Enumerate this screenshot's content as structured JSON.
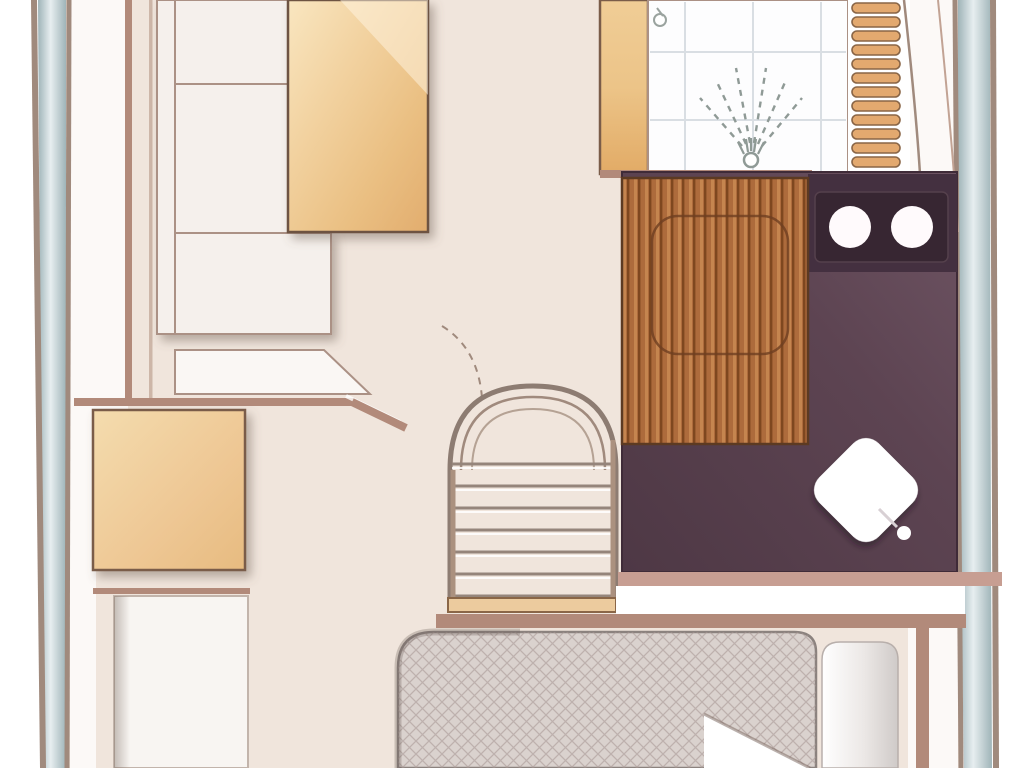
{
  "app": {
    "type": "boat-interior-floor-plan",
    "view": "top-down-deck-plan"
  },
  "palette": {
    "outside": "#ffffff",
    "floor": "#f0e5dc",
    "margin": "#fcf9f7",
    "wall": "#b28a7a",
    "wall-light": "#c79e92",
    "wall-dark": "#7a5c49",
    "line": "#a08a7d",
    "hull-strip-light": "#e7eef0",
    "hull-strip-dark": "#9fb4b8",
    "sofa": "#f5f0ec",
    "sofa-line": "#ab9185",
    "ledge": "#faf7f4",
    "berth": "#f8f5f2",
    "table-light": "#f9e6c0",
    "table-dark": "#e2ad6e",
    "table-edge": "#6d5243",
    "tile": "#fdfdfe",
    "tile-grid": "#d9dee3",
    "spray": "#8f9a96",
    "rung": "#e3a96f",
    "rung-edge": "#8a6647",
    "threshold": "#eccb9e",
    "purple-deep": "#4e3845",
    "purple-mid": "#5d4452",
    "purple-hi": "#6e5463",
    "counter": "#443040",
    "basin": "#372632",
    "sink": "#fffafc",
    "teak-base": "#ad6b3c",
    "teak-dark": "#7e471f",
    "teak-light": "#c5854f",
    "teak-edge": "#5c3a22",
    "mattress": "#dad2ce",
    "mattress-edge": "#8b827e",
    "cross-line": "#b3a6a1",
    "duvet-shade": "#cfcac8",
    "walkway": "#ffffff",
    "toilet": "#ffffff"
  },
  "rooms": {
    "saloon": {
      "features": [
        "l-shaped-sofa",
        "dinette-table",
        "side-ledge"
      ]
    },
    "lower_cabin": {
      "features": [
        "wood-cabinet",
        "single-berth"
      ]
    },
    "bathroom": {
      "features": [
        "tiled-shower",
        "shower-spray",
        "teak-grate-floor",
        "twin-sink-vanity",
        "toilet"
      ]
    },
    "bow_cabin": {
      "features": [
        "double-berth-mattress",
        "folded-sheet-corner",
        "duvet-roll"
      ]
    },
    "circulation": {
      "features": [
        "companionway-stairs",
        "boarding-ladder",
        "door-swing-arc",
        "walkway"
      ]
    }
  },
  "stairs": {
    "step_count": 7,
    "x1": 452,
    "x2": 614,
    "y_first": 464,
    "y_step": 22
  },
  "ladder": {
    "rung_count": 12,
    "x": 852,
    "w": 48,
    "h": 10,
    "y_first": 3,
    "y_step": 14
  },
  "shower": {
    "tile_columns": 3,
    "tile_rows": 2
  },
  "vanity": {
    "sink_count": 2
  }
}
